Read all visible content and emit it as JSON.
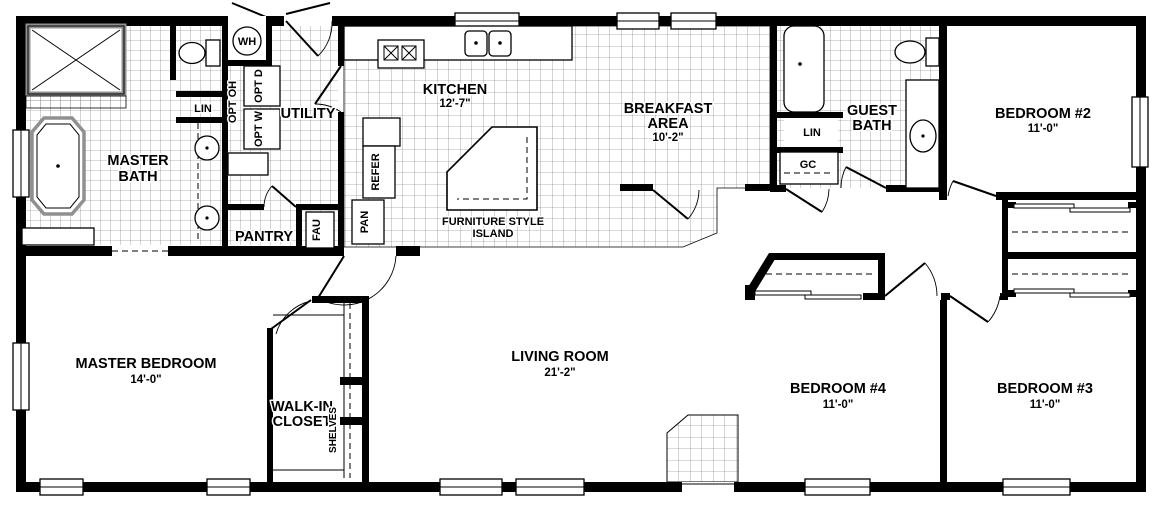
{
  "floorplan": {
    "rooms": {
      "master_bath": {
        "name1": "MASTER",
        "name2": "BATH"
      },
      "utility": {
        "name": "UTILITY"
      },
      "pantry": {
        "name": "PANTRY"
      },
      "kitchen": {
        "name": "KITCHEN",
        "dim": "12'-7\""
      },
      "breakfast": {
        "name1": "BREAKFAST",
        "name2": "AREA",
        "dim": "10'-2\""
      },
      "guest_bath": {
        "name1": "GUEST",
        "name2": "BATH"
      },
      "bedroom_2": {
        "name": "BEDROOM #2",
        "dim": "11'-0\""
      },
      "master_bedroom": {
        "name": "MASTER BEDROOM",
        "dim": "14'-0\""
      },
      "walk_in_closet": {
        "name1": "WALK-IN",
        "name2": "CLOSET"
      },
      "living_room": {
        "name": "LIVING ROOM",
        "dim": "21'-2\""
      },
      "bedroom_4": {
        "name": "BEDROOM #4",
        "dim": "11'-0\""
      },
      "bedroom_3": {
        "name": "BEDROOM #3",
        "dim": "11'-0\""
      }
    },
    "labels": {
      "water_heater": "WH",
      "linen_master": "LIN",
      "linen_guest": "LIN",
      "general_closet": "GC",
      "opt_overhead": "OPT OH",
      "opt_dryer": "OPT D",
      "opt_washer": "OPT W",
      "furnace": "FAU",
      "pan_cabinet": "PAN",
      "refrigerator": "REFER",
      "island_line1": "FURNITURE STYLE",
      "island_line2": "ISLAND",
      "shelves": "SHELVES"
    },
    "colors": {
      "wall": "#000000",
      "floor": "#ffffff",
      "tile_line": "#6e6e6e",
      "fixture_gray": "#909090"
    }
  }
}
